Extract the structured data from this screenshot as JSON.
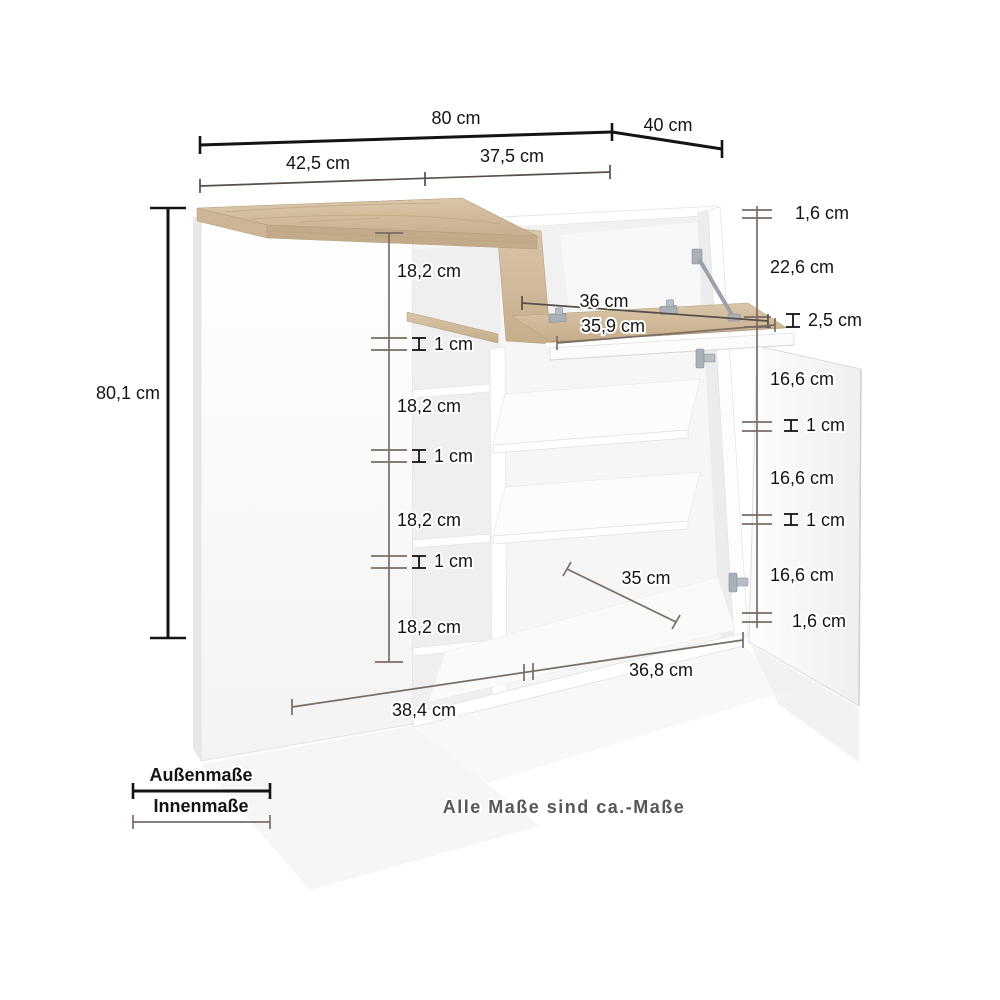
{
  "note": "Alle Maße sind ca.-Maße",
  "legend": {
    "outer": "Außenmaße",
    "inner": "Innenmaße"
  },
  "dimensions": {
    "width_outer": "80 cm",
    "depth_outer": "40 cm",
    "height_outer": "80,1 cm",
    "top_inner_left": "42,5 cm",
    "top_inner_right": "37,5 cm",
    "left_shelf_1": "18,2 cm",
    "left_gap_1": "1 cm",
    "left_shelf_2": "18,2 cm",
    "left_gap_2": "1 cm",
    "left_shelf_3": "18,2 cm",
    "left_gap_3": "1 cm",
    "left_shelf_4": "18,2 cm",
    "right_top_panel": "1,6 cm",
    "right_flap_compartment": "22,6 cm",
    "right_flap_thickness": "2,5 cm",
    "right_shelf_1": "16,6 cm",
    "right_gap_1": "1 cm",
    "right_shelf_2": "16,6 cm",
    "right_gap_2": "1 cm",
    "right_shelf_3": "16,6 cm",
    "right_bottom_panel": "1,6 cm",
    "flap_compartment_floor_width": "36 cm",
    "flap_width": "35,9 cm",
    "inner_depth": "35 cm",
    "bottom_inner_left": "38,4 cm",
    "bottom_inner_right": "36,8 cm"
  },
  "colors": {
    "outer_line": "#141414",
    "inner_line": "#7a6d64",
    "label_text": "#141414",
    "note_text": "#575757",
    "wood": "#d5c2a4",
    "wood_shadow": "#b49b78",
    "cabinet_white": "#ffffff",
    "metal": "#aab0b8"
  }
}
